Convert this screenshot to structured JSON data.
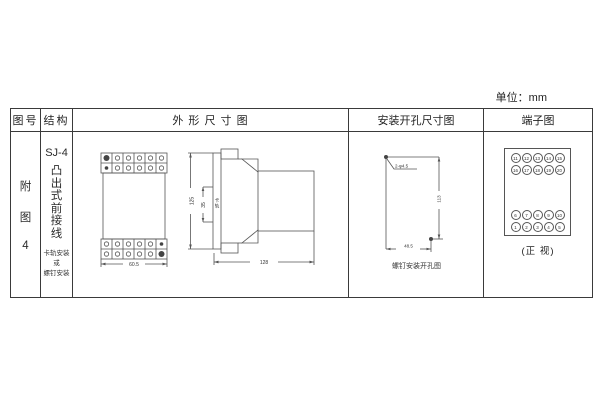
{
  "page": {
    "unit_label": "单位：mm"
  },
  "table": {
    "headers": {
      "fig_no": "图号",
      "structure": "结构",
      "outline": "外 形 尺 寸 图",
      "mounting": "安装开孔尺寸图",
      "terminal": "端子图"
    }
  },
  "fig_no": {
    "chars": [
      "附",
      "图",
      "4"
    ]
  },
  "structure": {
    "model": "SJ-4",
    "type_chars": [
      "凸",
      "出",
      "式",
      "前",
      "接",
      "线"
    ],
    "mount_note": [
      "卡轨安装",
      "或",
      "螺钉安装"
    ]
  },
  "outline": {
    "front_width": "60.5",
    "side_height": "125",
    "rail_width": "35",
    "rail_label_chars": [
      "卡",
      "轨"
    ],
    "side_length": "128"
  },
  "mounting": {
    "holes_label": "2-φ4.5",
    "vertical_dim": "113",
    "horizontal_dim": "48.5",
    "caption": "螺钉安装开孔图"
  },
  "terminal": {
    "rows_top": [
      [
        "11",
        "12",
        "13",
        "14",
        "15"
      ],
      [
        "16",
        "17",
        "18",
        "19",
        "20"
      ]
    ],
    "rows_bottom": [
      [
        "6",
        "7",
        "8",
        "9",
        "10"
      ],
      [
        "1",
        "2",
        "3",
        "4",
        "5"
      ]
    ],
    "caption": "(正 视)"
  }
}
